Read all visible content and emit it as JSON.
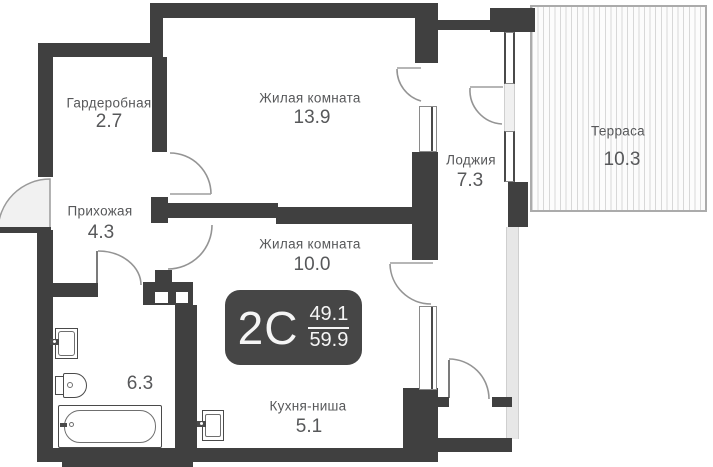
{
  "rooms": [
    {
      "key": "wardrobe",
      "name": "Гардеробная",
      "area": "2.7"
    },
    {
      "key": "living-room-1",
      "name": "Жилая комната",
      "area": "13.9"
    },
    {
      "key": "loggia",
      "name": "Лоджия",
      "area": "7.3"
    },
    {
      "key": "terrace",
      "name": "Терраса",
      "area": "10.3"
    },
    {
      "key": "hallway",
      "name": "Прихожая",
      "area": "4.3"
    },
    {
      "key": "living-room-2",
      "name": "Жилая комната",
      "area": "10.0"
    },
    {
      "key": "bathroom",
      "name": "",
      "area": "6.3"
    },
    {
      "key": "kitchen-niche",
      "name": "Кухня-ниша",
      "area": "5.1"
    }
  ],
  "badge": {
    "type_label": "2С",
    "area_upper": "49.1",
    "area_lower": "59.9"
  },
  "fixtures": [
    "washbasin-icon",
    "toilet-icon",
    "bathtub-icon",
    "kitchen-sink-icon",
    "ventilation-shaft"
  ],
  "colors": {
    "wall": "#404040",
    "door_arc": "#949494",
    "label_text": "#57585a",
    "badge_bg": "#464646",
    "badge_text": "#f5f5f5",
    "terrace_border": "#ababab",
    "terrace_stripe": "#d8d8d8",
    "glazing": "#e7e7e7"
  }
}
